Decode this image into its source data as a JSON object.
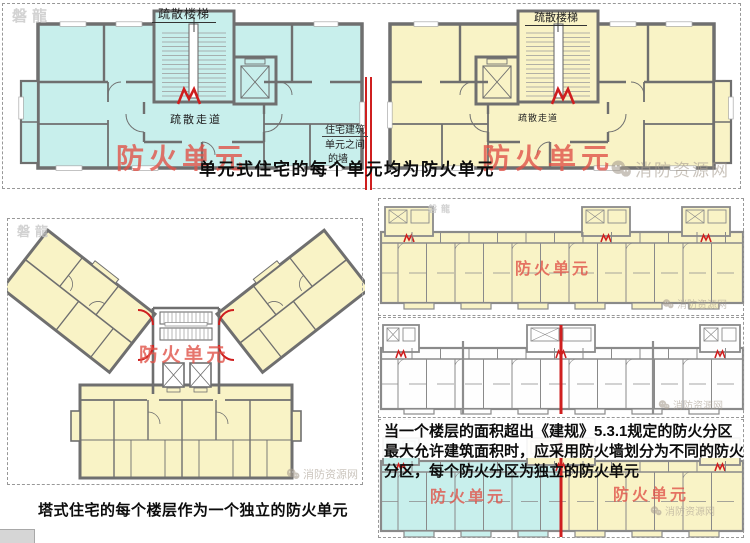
{
  "colors": {
    "cyan": "#c8efec",
    "yellow": "#f9f3c6",
    "red_label": "#e0524a",
    "red_wall": "#cf1f1f",
    "wall": "#6f6f6f",
    "slab_wall": "#8a8a8a",
    "watermark": "#a89e91"
  },
  "watermark": {
    "site": "消防资源网",
    "logo": "磐龍"
  },
  "top_section": {
    "caption": "单元式住宅的每个单元均为防火单元",
    "left_plan": {
      "stair_label": "疏散楼梯",
      "corridor_label": "疏散走道",
      "unit_label": "防火单元"
    },
    "right_plan": {
      "stair_label": "疏散楼梯",
      "corridor_label": "疏散走道",
      "unit_label": "防火单元"
    },
    "wall_label_lines": [
      "住宅建筑",
      "单元之间",
      "的墙"
    ]
  },
  "tower_section": {
    "caption": "塔式住宅的每个楼层作为一个独立的防火单元",
    "unit_label": "防火单元"
  },
  "right_panels": {
    "panel1": {
      "unit_label": "防火单元"
    },
    "panel3": {
      "paragraph_lines": [
        "当一个楼层的面积超出《建规》5.3.1规定的防火分区",
        "最大允许建筑面积时，应采用防火墙划分为不同的防火",
        "分区，每个防火分区为独立的防火单元"
      ],
      "left_unit_label": "防火单元",
      "right_unit_label": "防火单元"
    }
  }
}
